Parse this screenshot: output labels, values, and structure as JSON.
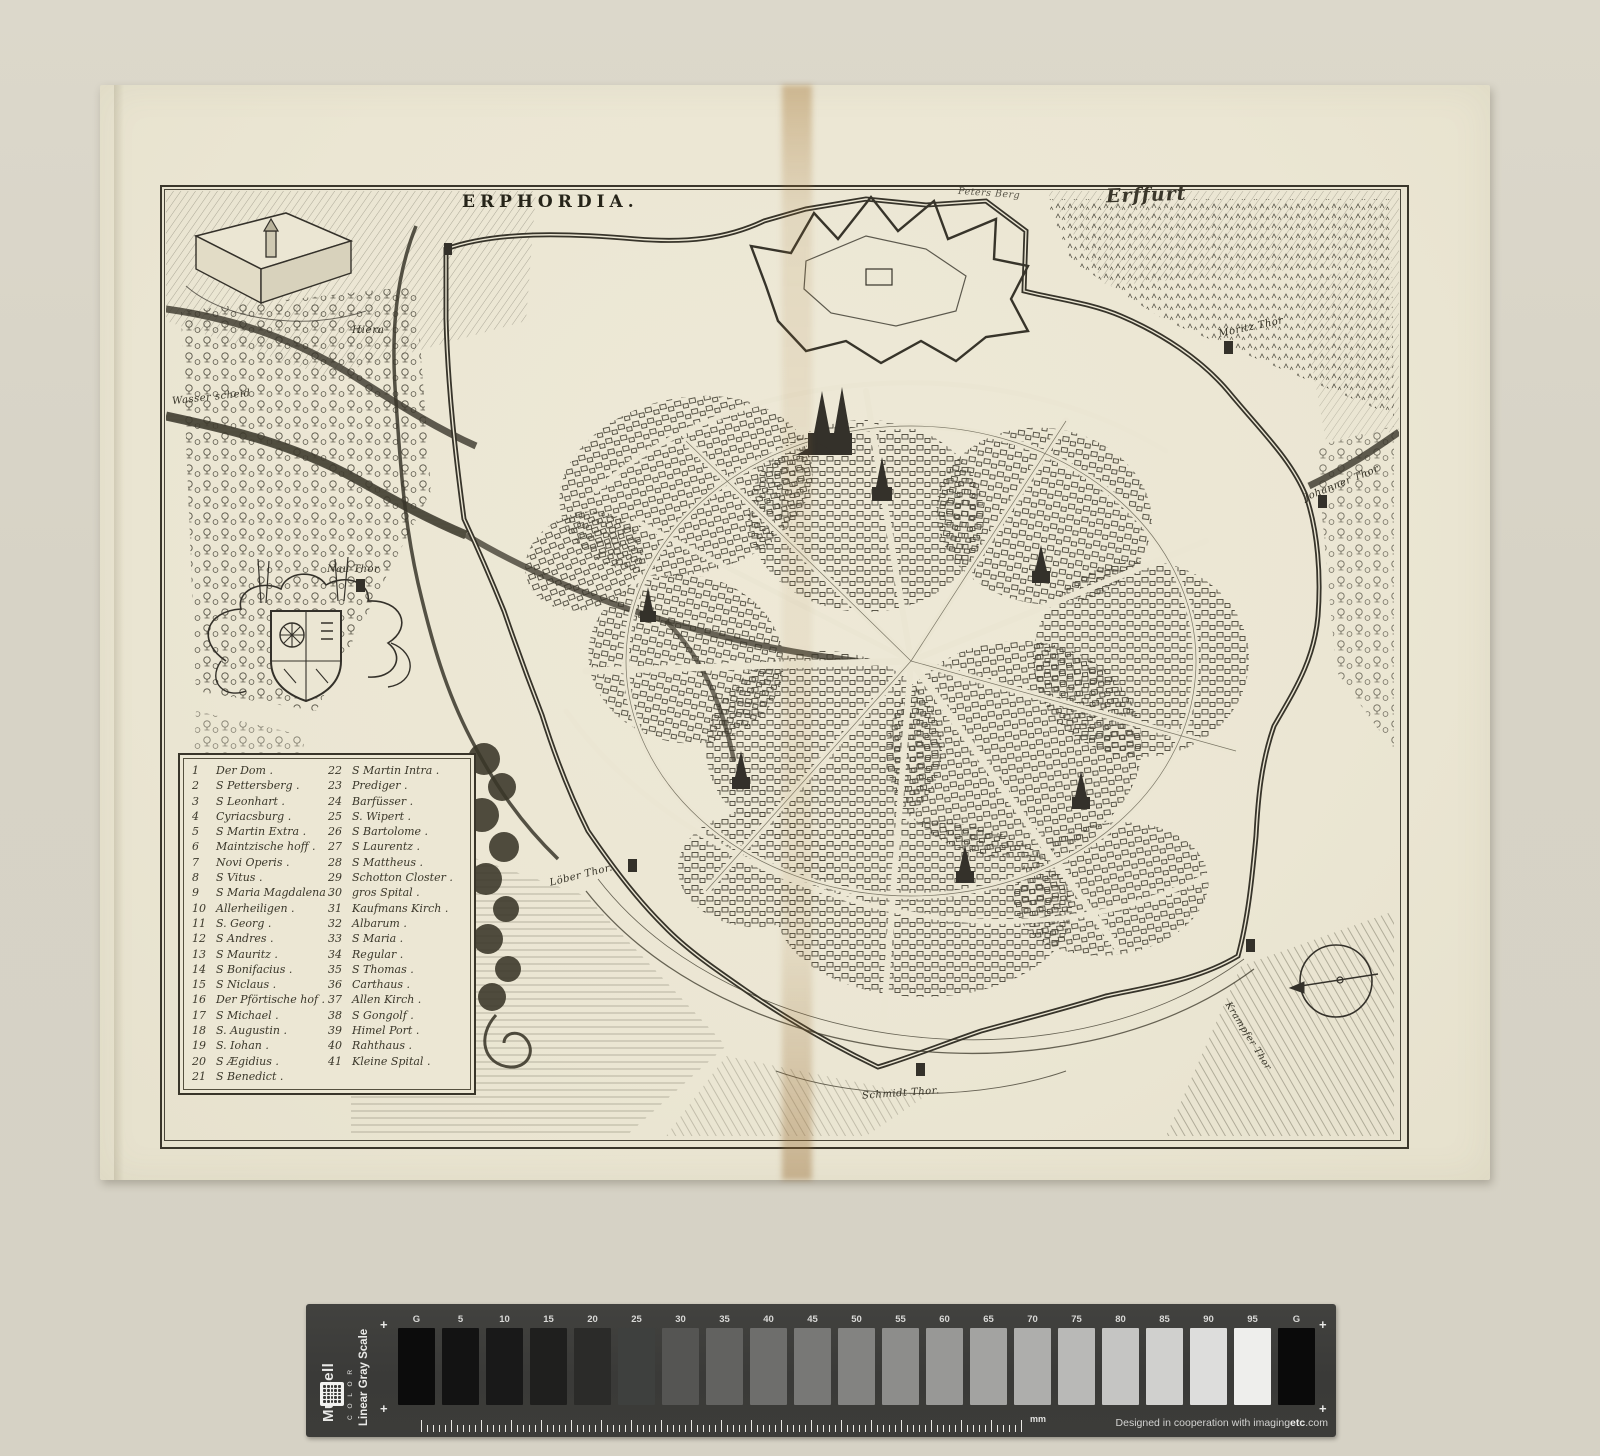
{
  "engraving": {
    "title": "ERPHORDIA.",
    "city_name_fraktur": "Erffurt",
    "map_labels": {
      "hiera": "Hiera",
      "wasserscheid": "Wasser scheid",
      "nau_thor": "Nau Thor",
      "loeber_thor": "Löber Thor.",
      "schmidt_thor": "Schmidt Thor.",
      "moritz_thor": "Moritz Thor",
      "johanner_thor": "Johanner Thor",
      "krampfer_thor": "Krampfer Thor",
      "peters_berg": "Peters Berg"
    },
    "legend": {
      "col1": [
        {
          "n": "1",
          "name": "Der Dom ."
        },
        {
          "n": "2",
          "name": "S Pettersberg ."
        },
        {
          "n": "3",
          "name": "S Leonhart ."
        },
        {
          "n": "4",
          "name": "Cyriacsburg ."
        },
        {
          "n": "5",
          "name": "S Martin Extra ."
        },
        {
          "n": "6",
          "name": "Maintzische hoff ."
        },
        {
          "n": "7",
          "name": "Novi Operis ."
        },
        {
          "n": "8",
          "name": "S Vitus ."
        },
        {
          "n": "9",
          "name": "S Maria Magdalena ."
        },
        {
          "n": "10",
          "name": "Allerheiligen ."
        },
        {
          "n": "11",
          "name": "S. Georg ."
        },
        {
          "n": "12",
          "name": "S Andres ."
        },
        {
          "n": "13",
          "name": "S Mauritz ."
        },
        {
          "n": "14",
          "name": "S Bonifacius ."
        },
        {
          "n": "15",
          "name": "S Niclaus ."
        },
        {
          "n": "16",
          "name": "Der Pförtische hof ."
        },
        {
          "n": "17",
          "name": "S Michael ."
        },
        {
          "n": "18",
          "name": "S. Augustin ."
        },
        {
          "n": "19",
          "name": "S. Iohan ."
        },
        {
          "n": "20",
          "name": "S Ægidius ."
        },
        {
          "n": "21",
          "name": "S Benedict ."
        }
      ],
      "col2": [
        {
          "n": "22",
          "name": "S Martin Intra ."
        },
        {
          "n": "23",
          "name": "Prediger ."
        },
        {
          "n": "24",
          "name": "Barfüsser ."
        },
        {
          "n": "25",
          "name": "S. Wipert ."
        },
        {
          "n": "26",
          "name": "S Bartolome ."
        },
        {
          "n": "27",
          "name": "S Laurentz ."
        },
        {
          "n": "28",
          "name": "S Mattheus ."
        },
        {
          "n": "29",
          "name": "Schotton Closter ."
        },
        {
          "n": "30",
          "name": "gros Spital ."
        },
        {
          "n": "31",
          "name": "Kaufmans Kirch ."
        },
        {
          "n": "32",
          "name": "Albarum ."
        },
        {
          "n": "33",
          "name": "S Maria ."
        },
        {
          "n": "34",
          "name": "Regular ."
        },
        {
          "n": "35",
          "name": "S Thomas ."
        },
        {
          "n": "36",
          "name": "Carthaus ."
        },
        {
          "n": "37",
          "name": "Allen Kirch ."
        },
        {
          "n": "38",
          "name": "S Gongolf ."
        },
        {
          "n": "39",
          "name": "Himel Port ."
        },
        {
          "n": "40",
          "name": "Rahthaus ."
        },
        {
          "n": "41",
          "name": "Kleine Spital ."
        }
      ]
    }
  },
  "grayscale_bar": {
    "brand": "Munsell",
    "brand_sub": "C O L O R",
    "scale_name": "Linear Gray Scale",
    "plus_mark": "+",
    "ruler_unit": "mm",
    "credit_prefix": "Designed in cooperation with imaging",
    "credit_bold": "etc",
    "credit_suffix": ".com",
    "patches": [
      {
        "label": "G",
        "hex": "#0c0c0c"
      },
      {
        "label": "5",
        "hex": "#131313"
      },
      {
        "label": "10",
        "hex": "#191919"
      },
      {
        "label": "15",
        "hex": "#1f1f1e"
      },
      {
        "label": "20",
        "hex": "#2b2b29"
      },
      {
        "label": "25",
        "hex": "#3e403e"
      },
      {
        "label": "30",
        "hex": "#555553"
      },
      {
        "label": "35",
        "hex": "#626260"
      },
      {
        "label": "40",
        "hex": "#6e6e6c"
      },
      {
        "label": "45",
        "hex": "#787876"
      },
      {
        "label": "50",
        "hex": "#838381"
      },
      {
        "label": "55",
        "hex": "#8d8d8b"
      },
      {
        "label": "60",
        "hex": "#989896"
      },
      {
        "label": "65",
        "hex": "#a3a3a1"
      },
      {
        "label": "70",
        "hex": "#aeaeac"
      },
      {
        "label": "75",
        "hex": "#b9b9b7"
      },
      {
        "label": "80",
        "hex": "#c5c5c3"
      },
      {
        "label": "85",
        "hex": "#d0d0ce"
      },
      {
        "label": "90",
        "hex": "#dddddc"
      },
      {
        "label": "95",
        "hex": "#eeeeec"
      },
      {
        "label": "G",
        "hex": "#0a0a0a"
      }
    ],
    "colors": {
      "bar_bg": "#3c3c39",
      "label_text": "#d9d9d7"
    }
  },
  "scan_colors": {
    "background": "#d7d3c6",
    "paper": "#ebe6d3",
    "ink": "#35322a",
    "stain": "#a87a3a"
  }
}
